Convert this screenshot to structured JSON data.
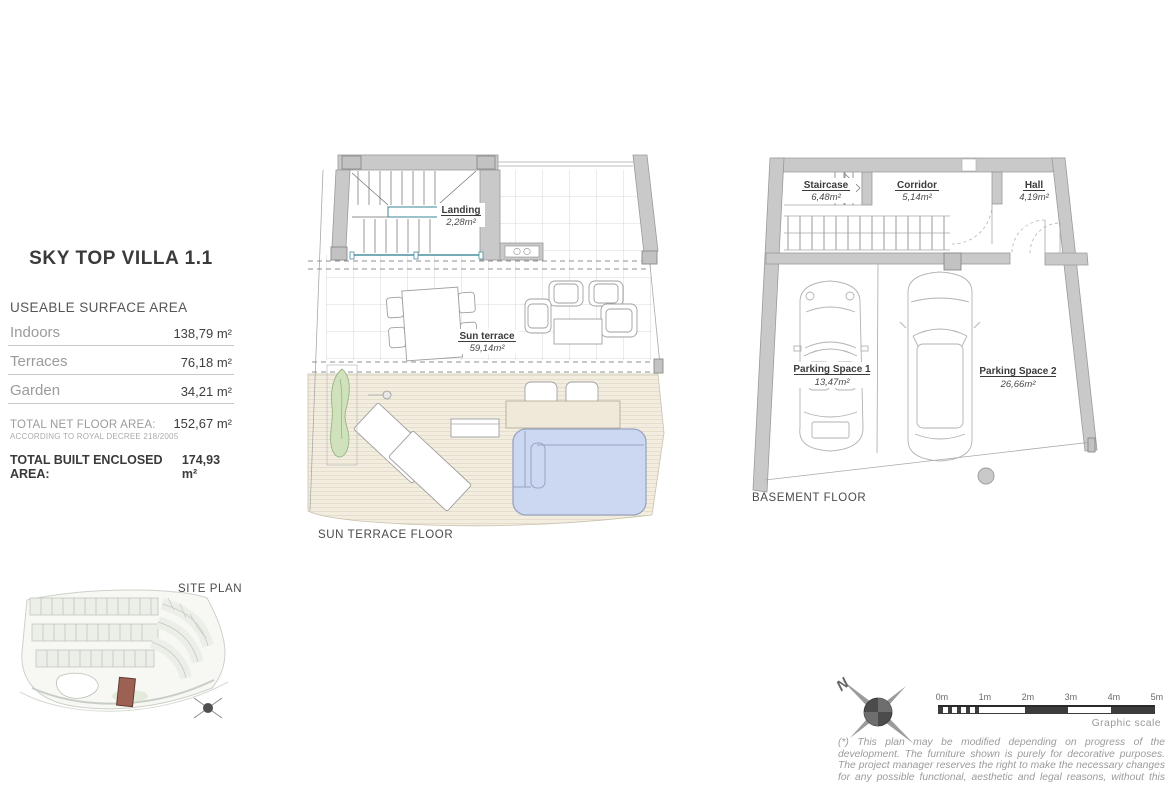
{
  "info_panel": {
    "title": "SKY TOP VILLA 1.1",
    "section_header": "USEABLE SURFACE AREA",
    "rows": [
      {
        "label": "Indoors",
        "value": "138,79 m²"
      },
      {
        "label": "Terraces",
        "value": "76,18 m²"
      },
      {
        "label": "Garden",
        "value": "34,21 m²"
      }
    ],
    "net_total_label": "TOTAL NET FLOOR AREA:",
    "net_total_value": "152,67  m²",
    "net_total_note": "ACCORDING TO ROYAL DECREE 218/2005",
    "built_total_label": "TOTAL BUILT ENCLOSED AREA:",
    "built_total_value": "174,93 m²"
  },
  "plans": {
    "sun_terrace": {
      "caption": "SUN TERRACE FLOOR",
      "landing_name": "Landing",
      "landing_area": "2,28m²",
      "terrace_name": "Sun terrace",
      "terrace_area": "59,14m²"
    },
    "basement": {
      "caption": "BASEMENT FLOOR",
      "staircase_name": "Staircase",
      "staircase_area": "6,48m²",
      "corridor_name": "Corridor",
      "corridor_area": "5,14m²",
      "hall_name": "Hall",
      "hall_area": "4,19m²",
      "parking1_name": "Parking Space 1",
      "parking1_area": "13,47m²",
      "parking2_name": "Parking Space 2",
      "parking2_area": "26,66m²"
    }
  },
  "site_plan": {
    "caption": "SITE PLAN"
  },
  "compass": {
    "north": "N"
  },
  "scale_bar": {
    "ticks": [
      "0m",
      "1m",
      "2m",
      "3m",
      "4m",
      "5m"
    ],
    "caption": "Graphic scale"
  },
  "footnote": "(*) This plan may be modified depending on progress of the development. The furniture shown is purely for decorative purposes. The project manager reserves the right to make the necessary changes for any possible functional, aesthetic and legal reasons, without this",
  "colors": {
    "wall_gray": "#c9c9c9",
    "stair_teal": "#4a8fa0",
    "pool_blue": "#ccd8f2",
    "deck_cream": "#f2eddf",
    "plant_green": "#cfe2bb",
    "highlight_unit": "#9c6152"
  }
}
